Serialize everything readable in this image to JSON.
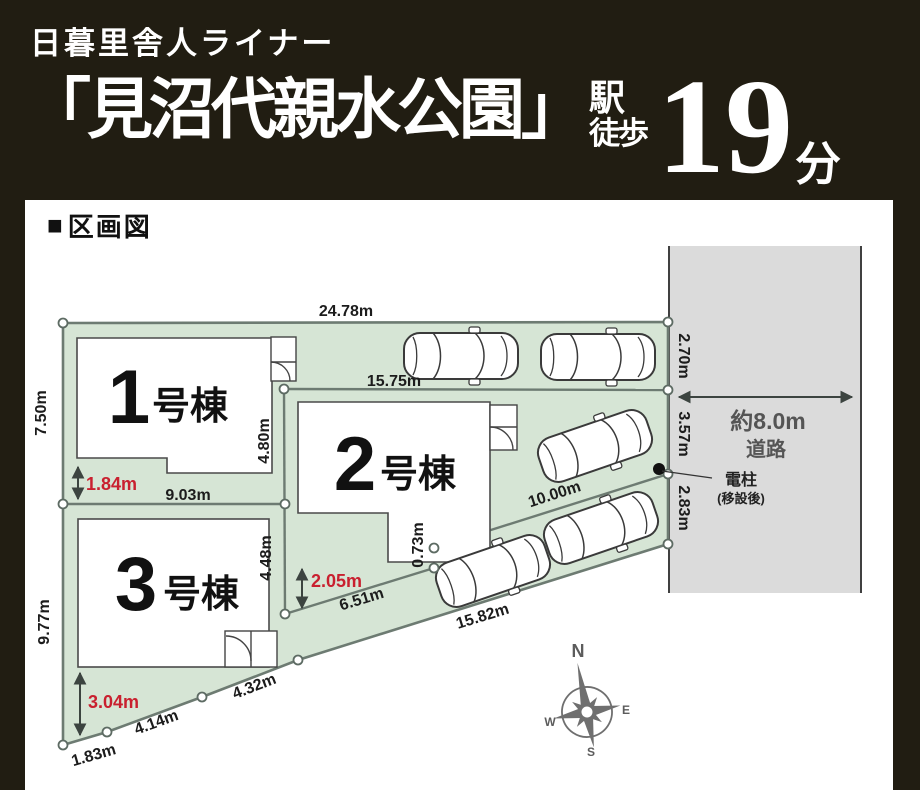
{
  "header": {
    "line1": "日暮里舎人ライナー",
    "station": "「見沼代親水公園」",
    "station_suffix1": "駅",
    "station_suffix2": "徒歩",
    "minutes": "19",
    "minutes_unit": "分"
  },
  "section": {
    "marker": "■",
    "title": "区画図"
  },
  "plan": {
    "buildings": [
      {
        "number": "1",
        "suffix": "号棟"
      },
      {
        "number": "2",
        "suffix": "号棟"
      },
      {
        "number": "3",
        "suffix": "号棟"
      }
    ],
    "dimensions": {
      "top": "24.78m",
      "plot2_top": "15.75m",
      "plot1_bottom": "9.03m",
      "left_upper": "7.50m",
      "left_lower": "9.77m",
      "divider_upper": "4.80m",
      "divider_lower": "4.48m",
      "jog": "0.73m",
      "right_1": "2.70m",
      "right_2": "3.57m",
      "right_3": "2.83m",
      "diag_1": "6.51m",
      "diag_2": "10.00m",
      "bottom_long": "15.82m",
      "bottom_1": "1.83m",
      "bottom_2": "4.14m",
      "bottom_3": "4.32m"
    },
    "red_dimensions": {
      "plot1": "1.84m",
      "plot2": "2.05m",
      "plot3": "3.04m"
    },
    "road": {
      "width": "約8.0m",
      "label": "道路"
    },
    "pole": {
      "name": "電柱",
      "note": "(移設後)"
    },
    "compass": {
      "n": "N",
      "e": "E",
      "s": "S",
      "w": "W"
    },
    "colors": {
      "header_bg": "#211d12",
      "site_fill": "#d6e5d5",
      "road_fill": "#dbdbdb",
      "boundary_line": "#6d7b72",
      "red": "#c9202f"
    }
  }
}
